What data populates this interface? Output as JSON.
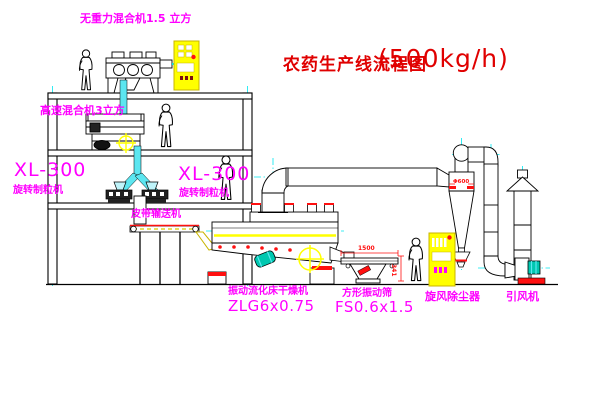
{
  "title": {
    "name_cn": "农药生产线流程图",
    "capacity": "(500kg/h)"
  },
  "equipment_labels": {
    "gravity_mixer": "无重力混合机1.5 立方",
    "high_speed_mixer": "高速混合机3立方",
    "granulator_left": {
      "model": "XL-300",
      "name": "旋转制粒机"
    },
    "granulator_right": {
      "model": "XL-300",
      "name": "旋转制粒机"
    },
    "belt_conveyor": "皮带输送机",
    "fluid_bed_dryer": {
      "name": "振动流化床干燥机",
      "model": "ZLG6x0.75"
    },
    "vibrating_screen": {
      "name": "方形振动筛",
      "model": "FS0.6x1.5"
    },
    "cyclone": "旋风除尘器",
    "induced_draft_fan": "引风机"
  },
  "dimensions": {
    "screen_length": "1500",
    "screen_height": "341",
    "cyclone_width": "Φ600"
  },
  "colors": {
    "label_magenta": "#ff00ff",
    "title_red": "#e00000",
    "line_black": "#000000",
    "centerline_cyan": "#00e6f0",
    "pipe_cyan": "#5ce6f0",
    "highlight_yellow": "#ffff00",
    "accent_red": "#ff1010",
    "motor_teal": "#00c8b0",
    "cabinet_yellow": "#ffff00"
  }
}
